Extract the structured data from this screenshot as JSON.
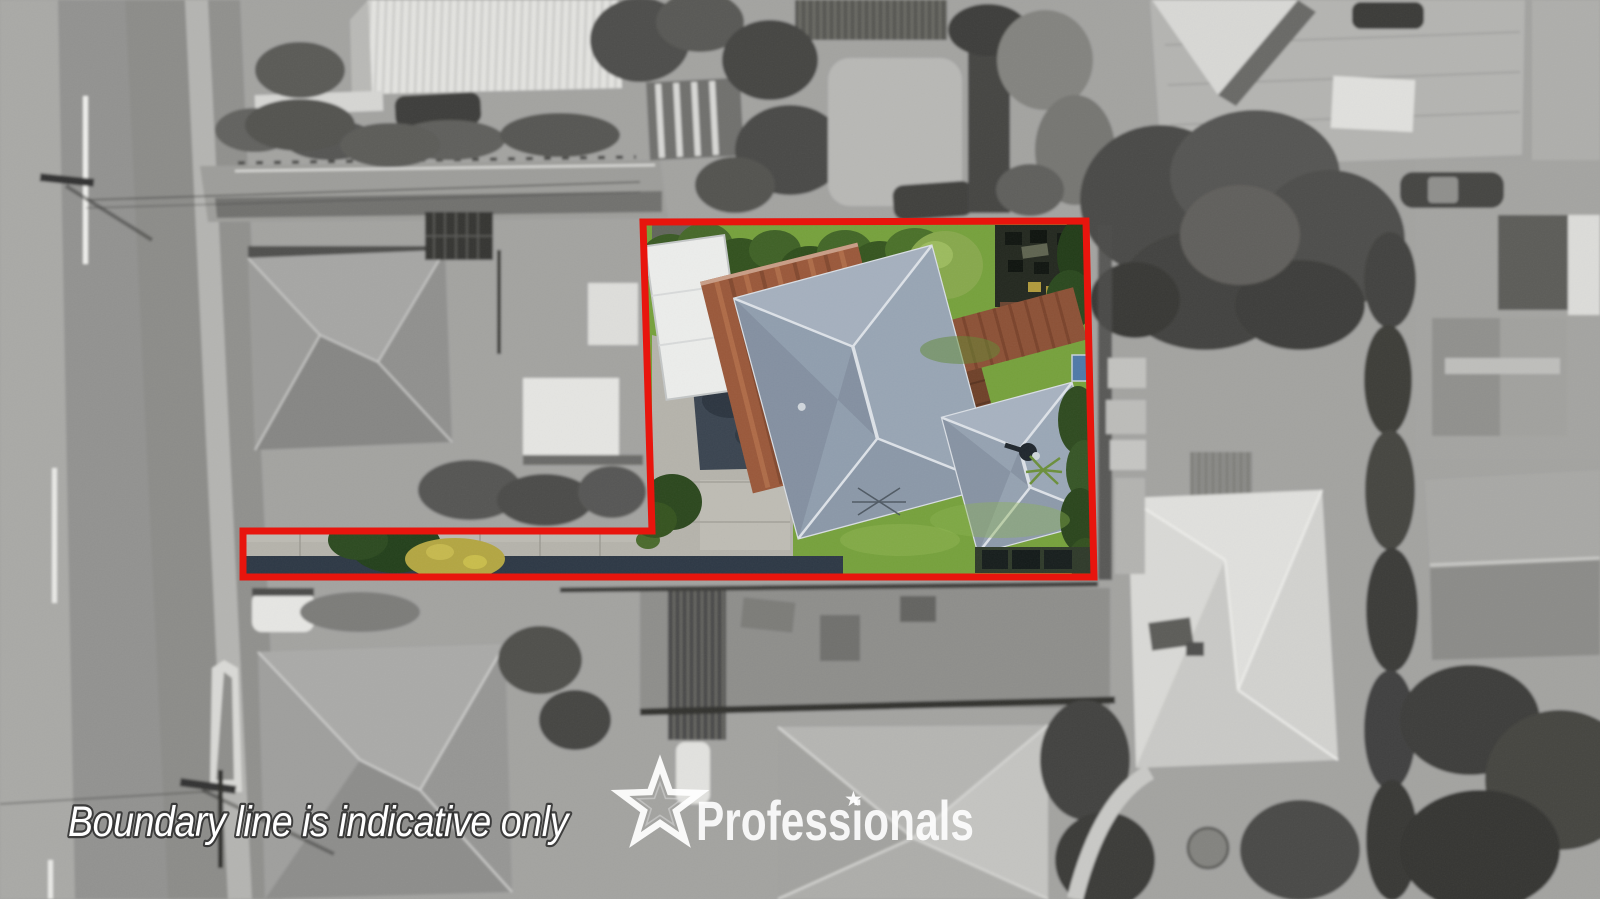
{
  "watermark": {
    "disclaimer": "Boundary line is indicative only"
  },
  "logo": {
    "brand": "Professionals",
    "star_glyph": "★"
  },
  "boundary": {
    "points": "643,222 1086,221 1094,577 243,577 243,531 652,531",
    "stroke": "#e8150d"
  },
  "property": {
    "colors": {
      "lawn": "#76a13c",
      "main_roof": "#909eae",
      "shed_roof": "#9a583a",
      "carport_roof": "#ecedeb",
      "driveway": "#b5b3ab",
      "asphalt": "#3a4450",
      "deck": "#6f4129"
    }
  }
}
